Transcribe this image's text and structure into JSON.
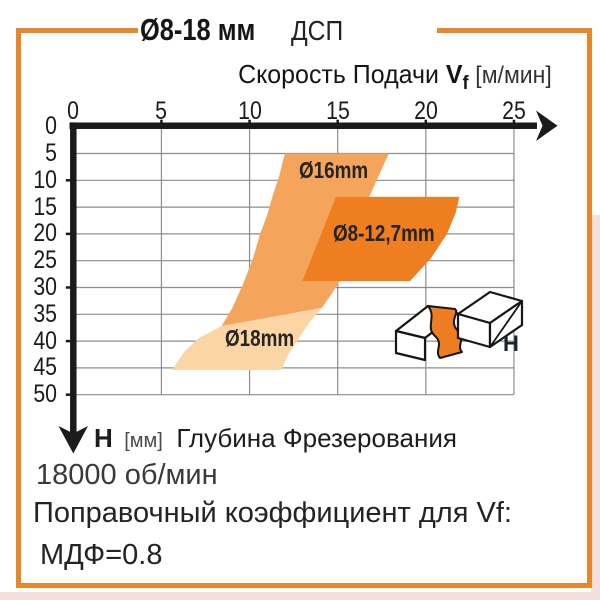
{
  "frame": {
    "border_color": "#e5872a"
  },
  "header": {
    "title": "Ø8-18 мм",
    "material": "ДСП"
  },
  "chart_data": {
    "type": "area",
    "xlabel_prefix": "Скорость Подачи",
    "xlabel_symbol": "V",
    "xlabel_symbol_sub": "f",
    "xlabel_unit": "[м/мин]",
    "ylabel_symbol": "H",
    "ylabel_unit": "[мм]",
    "ylabel_text": "Глубина Фрезерования",
    "xlim": [
      0,
      25
    ],
    "ylim": [
      0,
      50
    ],
    "y_axis_inverted": true,
    "grid": true,
    "x_ticks": [
      0,
      5,
      10,
      15,
      20,
      25
    ],
    "y_ticks": [
      0,
      5,
      10,
      15,
      20,
      25,
      30,
      35,
      40,
      45,
      50
    ],
    "bands": [
      {
        "label": "Ø16mm",
        "color": "#f5a55b",
        "region_vf_h": [
          [
            12,
            5
          ],
          [
            17.9,
            5
          ],
          [
            16.8,
            13
          ],
          [
            15.75,
            20
          ],
          [
            15.1,
            28.8
          ],
          [
            14.6,
            31.5
          ],
          [
            14.1,
            33.8
          ],
          [
            8.4,
            37.2
          ],
          [
            9.0,
            34.0
          ],
          [
            9.7,
            28.8
          ],
          [
            10.2,
            24.5
          ],
          [
            10.6,
            20
          ],
          [
            11.0,
            16.5
          ],
          [
            11.3,
            13
          ],
          [
            11.7,
            9
          ]
        ]
      },
      {
        "label": "Ø8-12,7mm",
        "color": "#ee7e20",
        "region_vf_h": [
          [
            14.9,
            13.1
          ],
          [
            21.9,
            13.1
          ],
          [
            21.7,
            16
          ],
          [
            21.2,
            20
          ],
          [
            20.3,
            24.5
          ],
          [
            19.1,
            28.8
          ],
          [
            13.0,
            28.8
          ]
        ]
      },
      {
        "label": "Ø18mm",
        "color": "#fbd5a4",
        "region_vf_h": [
          [
            8.4,
            37.2
          ],
          [
            14.1,
            33.8
          ],
          [
            13.4,
            36.5
          ],
          [
            12.8,
            39.5
          ],
          [
            12.2,
            42.5
          ],
          [
            11.8,
            45.4
          ],
          [
            5.6,
            45.4
          ],
          [
            6.3,
            42.0
          ],
          [
            7.1,
            39.5
          ]
        ]
      }
    ]
  },
  "icon": {
    "depth_label": "H"
  },
  "notes": {
    "rpm": "18000 об/мин",
    "coefficient_title": "Поправочный коэффициент для Vf:",
    "coefficient_mdf": "МДФ=0.8"
  }
}
